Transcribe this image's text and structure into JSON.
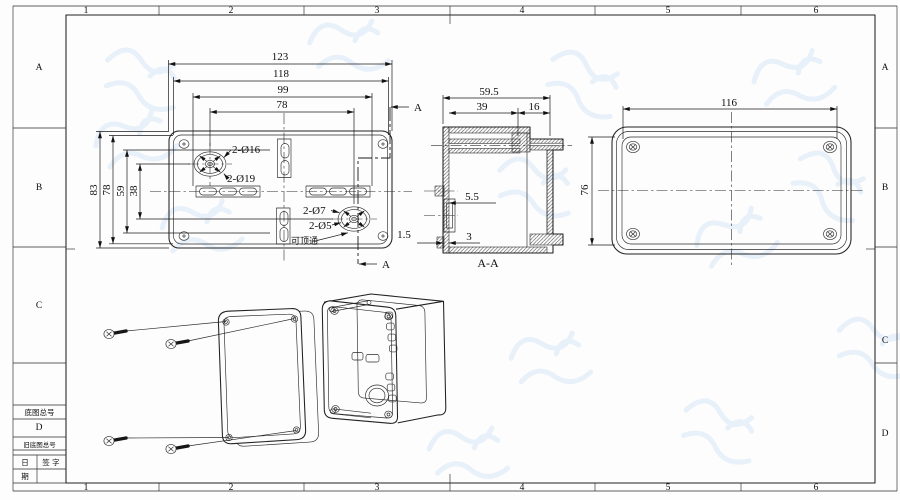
{
  "sheet": {
    "zones": {
      "cols": [
        "1",
        "2",
        "3",
        "4",
        "5",
        "6"
      ],
      "rows": [
        "A",
        "B",
        "C",
        "D"
      ]
    },
    "title_block": {
      "base_no": "底图总号",
      "old_base_no": "旧底图总号",
      "date_top": "日",
      "date_bottom": "期",
      "signature": "签 字"
    }
  },
  "views": {
    "front": {
      "d123": "123",
      "d118": "118",
      "d99": "99",
      "d78_top": "78",
      "d83": "83",
      "d78_left": "78",
      "d59": "59",
      "d38": "38",
      "c16": "2-Ø16",
      "c19": "2-Ø19",
      "c7": "2-Ø7",
      "c5": "2-Ø5",
      "knock": "可顶通",
      "section_a": "A"
    },
    "section": {
      "label": "A-A",
      "d595": "59.5",
      "d39": "39",
      "d16": "16",
      "d55": "5.5",
      "d3": "3",
      "d15": "1.5"
    },
    "side": {
      "d116": "116",
      "d76": "76"
    }
  },
  "colors": {
    "paper": "#fdfdfd",
    "line": "#212121",
    "watermark": "#d7e7f6"
  }
}
